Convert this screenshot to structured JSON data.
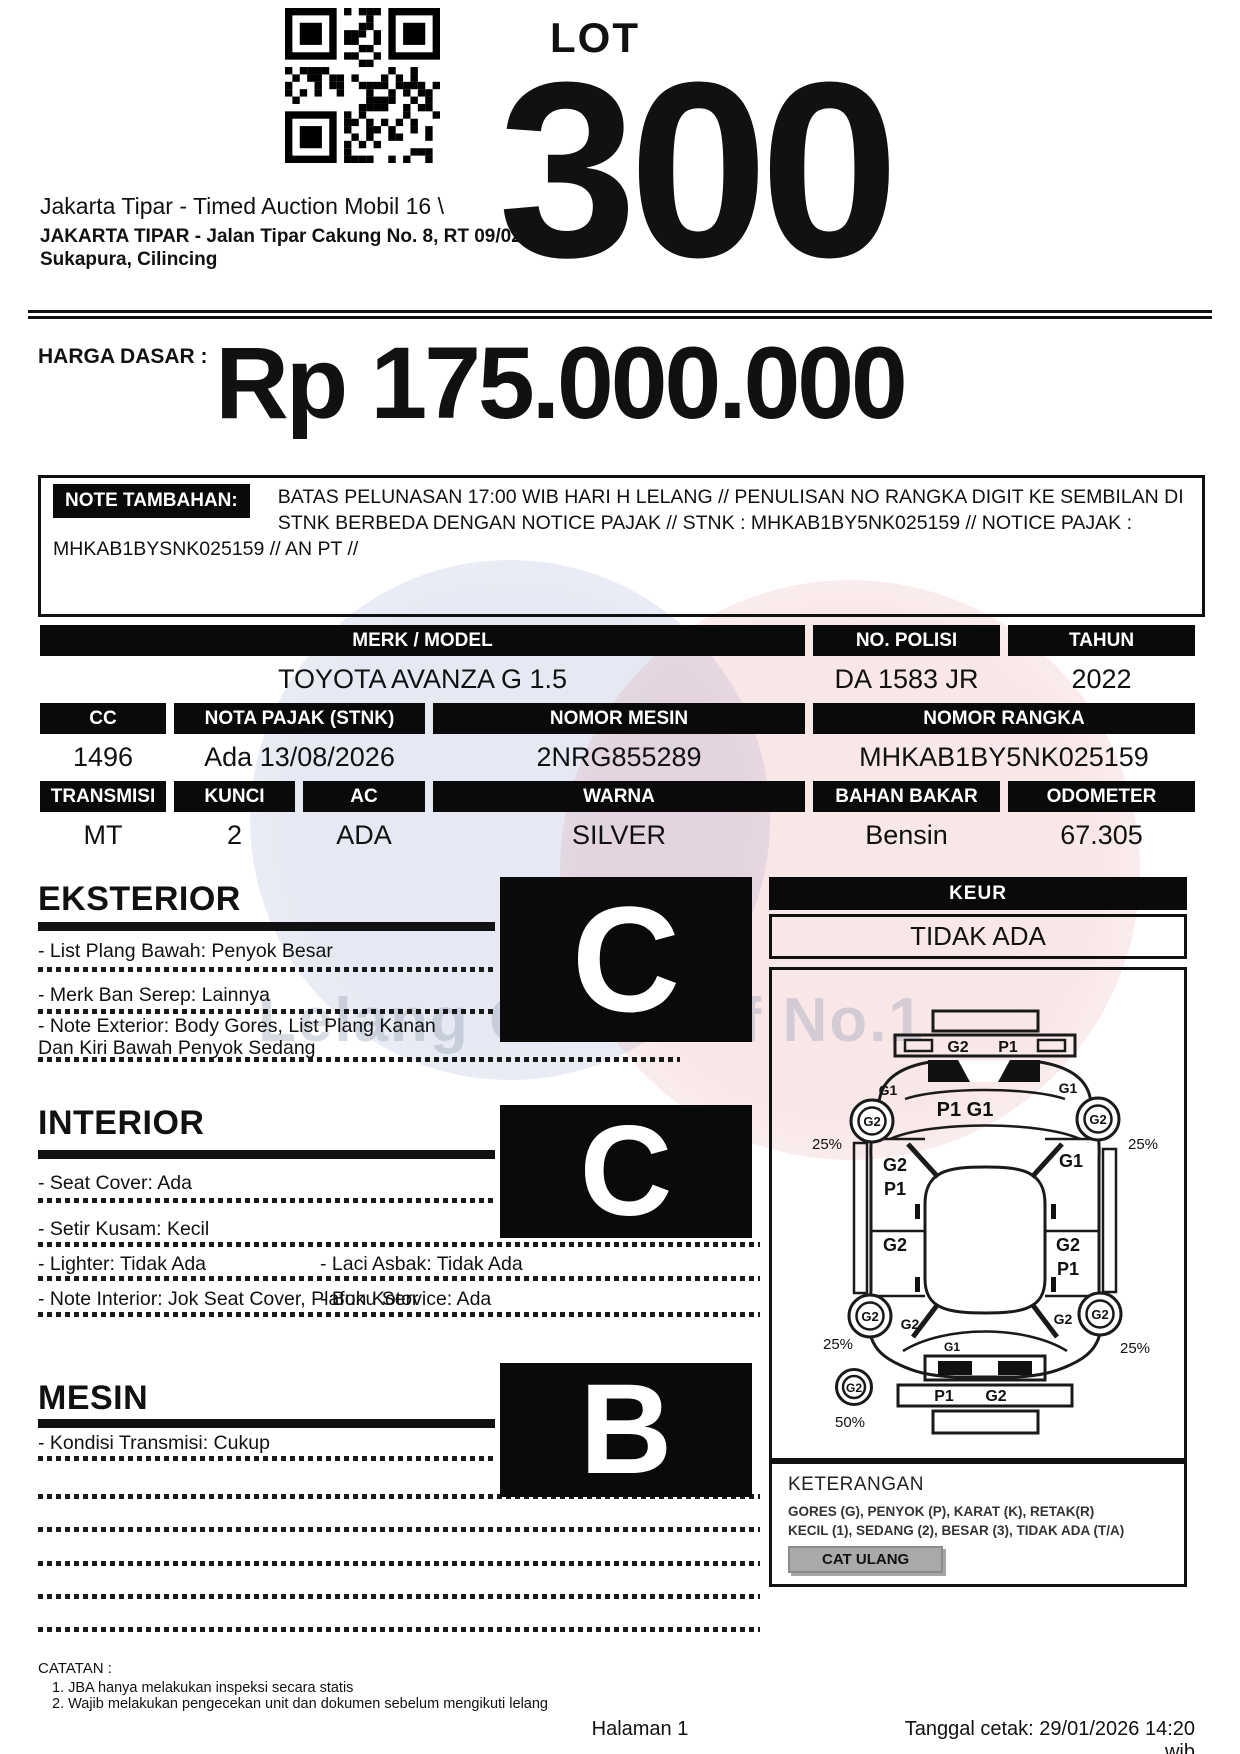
{
  "header": {
    "lot_label": "LOT",
    "lot_number": "300",
    "auction_title": "Jakarta Tipar - Timed Auction Mobil 16 \\",
    "venue_line1": "JAKARTA TIPAR - Jalan Tipar Cakung No. 8, RT 09/02,",
    "venue_line2": "Sukapura, Cilincing"
  },
  "price": {
    "label": "HARGA DASAR :",
    "value": "Rp 175.000.000"
  },
  "note": {
    "label": "NOTE TAMBAHAN:",
    "text": "BATAS PELUNASAN 17:00 WIB HARI H LELANG // PENULISAN NO RANGKA DIGIT KE SEMBILAN DI STNK BERBEDA DENGAN NOTICE PAJAK // STNK : MHKAB1BY5NK025159 // NOTICE PAJAK : MHKAB1BYSNK025159 // AN PT //"
  },
  "specs": {
    "merk_model": {
      "label": "MERK / MODEL",
      "value": "TOYOTA AVANZA G 1.5"
    },
    "no_polisi": {
      "label": "NO. POLISI",
      "value": "DA 1583 JR"
    },
    "tahun": {
      "label": "TAHUN",
      "value": "2022"
    },
    "cc": {
      "label": "CC",
      "value": "1496"
    },
    "nota_pajak": {
      "label": "NOTA PAJAK (STNK)",
      "value": "Ada 13/08/2026"
    },
    "nomor_mesin": {
      "label": "NOMOR MESIN",
      "value": "2NRG855289"
    },
    "nomor_rangka": {
      "label": "NOMOR RANGKA",
      "value": "MHKAB1BY5NK025159"
    },
    "transmisi": {
      "label": "TRANSMISI",
      "value": "MT"
    },
    "kunci": {
      "label": "KUNCI",
      "value": "2"
    },
    "ac": {
      "label": "AC",
      "value": "ADA"
    },
    "warna": {
      "label": "WARNA",
      "value": "SILVER"
    },
    "bahan_bakar": {
      "label": "BAHAN BAKAR",
      "value": "Bensin"
    },
    "odometer": {
      "label": "ODOMETER",
      "value": "67.305"
    }
  },
  "sections": {
    "eksterior": {
      "title": "EKSTERIOR",
      "grade": "C",
      "items": [
        "- List Plang Bawah: Penyok Besar",
        "- Merk Ban Serep: Lainnya",
        "- Note Exterior: Body Gores, List Plang Kanan\nDan Kiri Bawah Penyok Sedang"
      ]
    },
    "interior": {
      "title": "INTERIOR",
      "grade": "C",
      "rows": [
        {
          "left": "- Seat Cover: Ada",
          "right": ""
        },
        {
          "left": "- Setir Kusam: Kecil",
          "right": ""
        },
        {
          "left": "- Lighter: Tidak Ada",
          "right": "- Laci Asbak: Tidak Ada"
        },
        {
          "left": "- Note Interior: Jok Seat Cover, Plafon Kotor",
          "right": "- Buku Service: Ada"
        }
      ]
    },
    "mesin": {
      "title": "MESIN",
      "grade": "B",
      "items": [
        "- Kondisi Transmisi: Cukup"
      ]
    }
  },
  "keur": {
    "label": "KEUR",
    "value": "TIDAK ADA"
  },
  "diagram": {
    "labels": {
      "rear-bumper-g2": "G2",
      "rear-bumper-p1": "P1",
      "rear-left-fender": "G1",
      "rear-right-fender": "G1",
      "rear-left-wheel": "G2",
      "rear-left-wheel-pct": "25%",
      "rear-right-wheel": "G2",
      "rear-right-wheel-pct": "25%",
      "tailgate": "P1 G1",
      "left-rear-door-1": "G2",
      "left-rear-door-2": "P1",
      "left-front-door": "G2",
      "right-rear-door": "G1",
      "right-front-door-1": "G2",
      "right-front-door-2": "P1",
      "front-left-wheel": "G2",
      "front-left-wheel-side": "G2",
      "front-left-wheel-pct": "25%",
      "front-right-wheel": "G2",
      "front-right-wheel-side": "G2",
      "front-right-wheel-pct": "25%",
      "hood-edge": "G1",
      "front-bumper-p1": "P1",
      "front-bumper-g2": "G2",
      "spare-wheel": "G2",
      "spare-wheel-pct": "50%"
    }
  },
  "keterangan": {
    "title": "KETERANGAN",
    "line1": "GORES (G), PENYOK (P), KARAT (K), RETAK(R)",
    "line2": "KECIL (1), SEDANG (2), BESAR (3), TIDAK ADA (T/A)",
    "button": "CAT ULANG"
  },
  "footer": {
    "catatan_title": "CATATAN :",
    "items": [
      "1. JBA hanya melakukan inspeksi secara statis",
      "2. Wajib melakukan pengecekan unit dan dokumen sebelum mengikuti lelang"
    ],
    "page": "Halaman 1",
    "printed": "Tanggal cetak: 29/01/2026 14:20 wib"
  },
  "watermark": {
    "text": "Lelang Otomotif No.1"
  }
}
